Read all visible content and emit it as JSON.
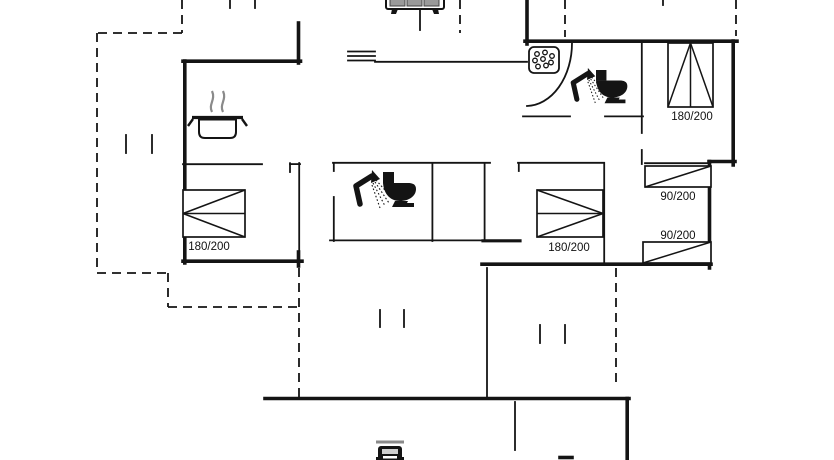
{
  "plan": {
    "type": "floor-plan",
    "beds": {
      "double_left": {
        "size_label": "180/200"
      },
      "double_middle": {
        "size_label": "180/200"
      },
      "double_top_right": {
        "size_label": "180/200"
      },
      "single_right_upper": {
        "size_label": "90/200"
      },
      "single_right_lower": {
        "size_label": "90/200"
      }
    },
    "icons": [
      "grill-icon",
      "vent-icon",
      "cooking-pot-icon",
      "whirlpool-icon",
      "shower-icon",
      "toilet-icon",
      "window-tick-icon",
      "car-icon"
    ],
    "colors": {
      "ink": "#141414",
      "muted_gray": "#8a8a8a",
      "background": "#ffffff"
    }
  }
}
